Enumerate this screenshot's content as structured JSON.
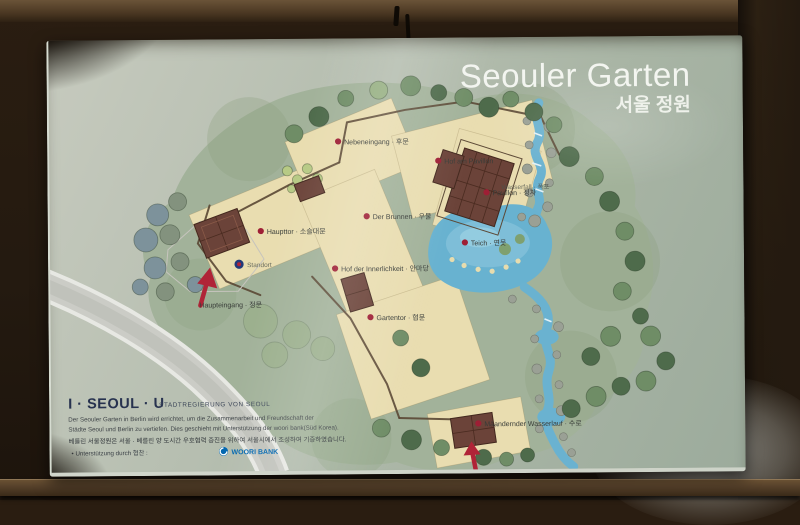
{
  "title": {
    "de": "Seouler Garten",
    "ko": "서울 정원"
  },
  "map": {
    "labels": [
      {
        "name": "haupteingang",
        "text": "Haupteingang · 정문"
      },
      {
        "name": "haupttor",
        "text": "Haupttor · 소슬대문"
      },
      {
        "name": "standort",
        "text": "Standort"
      },
      {
        "name": "hof-der-innerlichkeit",
        "text": "Hof der Innerlichkeit · 안마당"
      },
      {
        "name": "brunnen",
        "text": "Der Brunnen · 우물"
      },
      {
        "name": "nebeneingang",
        "text": "Nebeneingang · 후문"
      },
      {
        "name": "hof-am-pavillon",
        "text": "Hof am Pavillon"
      },
      {
        "name": "pavillon",
        "text": "Pavillon · 정자"
      },
      {
        "name": "teich",
        "text": "Teich · 연못"
      },
      {
        "name": "wasserfall",
        "text": "Wasserfall · 폭포"
      },
      {
        "name": "gartentor",
        "text": "Gartentor · 협문"
      },
      {
        "name": "maeandernder-wasserlauf",
        "text": "Mäandernder Wasserlauf · 수로"
      }
    ],
    "colors": {
      "marker_red": "#9e1f35",
      "pond_blue": "#68b2d0",
      "courtyard_beige": "#e9ddb0",
      "board_green": "#aab7a6"
    }
  },
  "footer": {
    "logo": "I · SEOUL · U",
    "logo_sub": "STADTREGIERUNG VON SEOUL",
    "desc_line1": "Der Seouler Garten in Berlin wird errichtet, um die Zusammenarbeit und Freundschaft der",
    "desc_line2": "Städte Seoul und Berlin zu vertiefen. Dies geschieht mit Unterstützung der woori bank(Süd Korea).",
    "desc_korean": "베를린 서울정원은 서울 · 베를린 양 도시간 우호협력 증진을 위하여 서울시에서 조성하여 기증하였습니다.",
    "support_label": "• Unterstützung durch 협찬 :",
    "bank_name": "WOORI BANK",
    "bank_blue": "#0067b0"
  }
}
